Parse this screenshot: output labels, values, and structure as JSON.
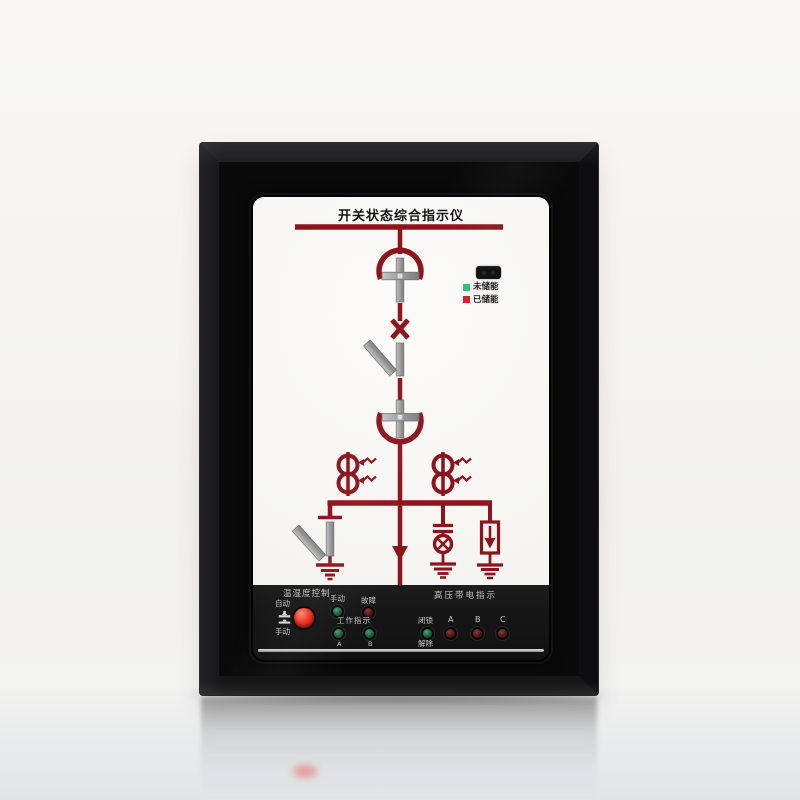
{
  "screen": {
    "title": "开关状态综合指示仪",
    "legend": {
      "not_charged": "未储能",
      "charged": "已储能",
      "not_charged_color": "#2fbe6e",
      "charged_color": "#d7182a"
    },
    "diagram": {
      "line_color": "#8c141d",
      "metal_color": "#a6a6a6",
      "symbols": [
        "busbar",
        "breaker-upper-arc",
        "truck-position-cross-upper",
        "closed-position-x",
        "disconnector-bar",
        "disconnector-blade",
        "truck-position-cross-lower",
        "breaker-lower-arc",
        "current-transformer-left",
        "current-transformer-right",
        "distribution-bar",
        "earthing-switch",
        "earth-electrode-left",
        "feeder-arrow",
        "capacitor-divider",
        "indicator-lamp",
        "earth-electrode-middle",
        "surge-arrester",
        "earth-electrode-right"
      ]
    }
  },
  "panel": {
    "temp_humidity_control": "温湿度控制",
    "auto": "自动",
    "manual": "手动",
    "manual_led": "手动",
    "fault_led": "故障",
    "work_indicator": "工作指示",
    "work_a": "A",
    "work_b": "B",
    "hv_live_indicator": "高压带电指示",
    "lock": "闭锁",
    "release": "解除",
    "phase_a": "A",
    "phase_b": "B",
    "phase_c": "C",
    "button_color": "#e2261a",
    "led_green_color": "#2f8a5f",
    "led_red_color": "#7a2a2a"
  }
}
